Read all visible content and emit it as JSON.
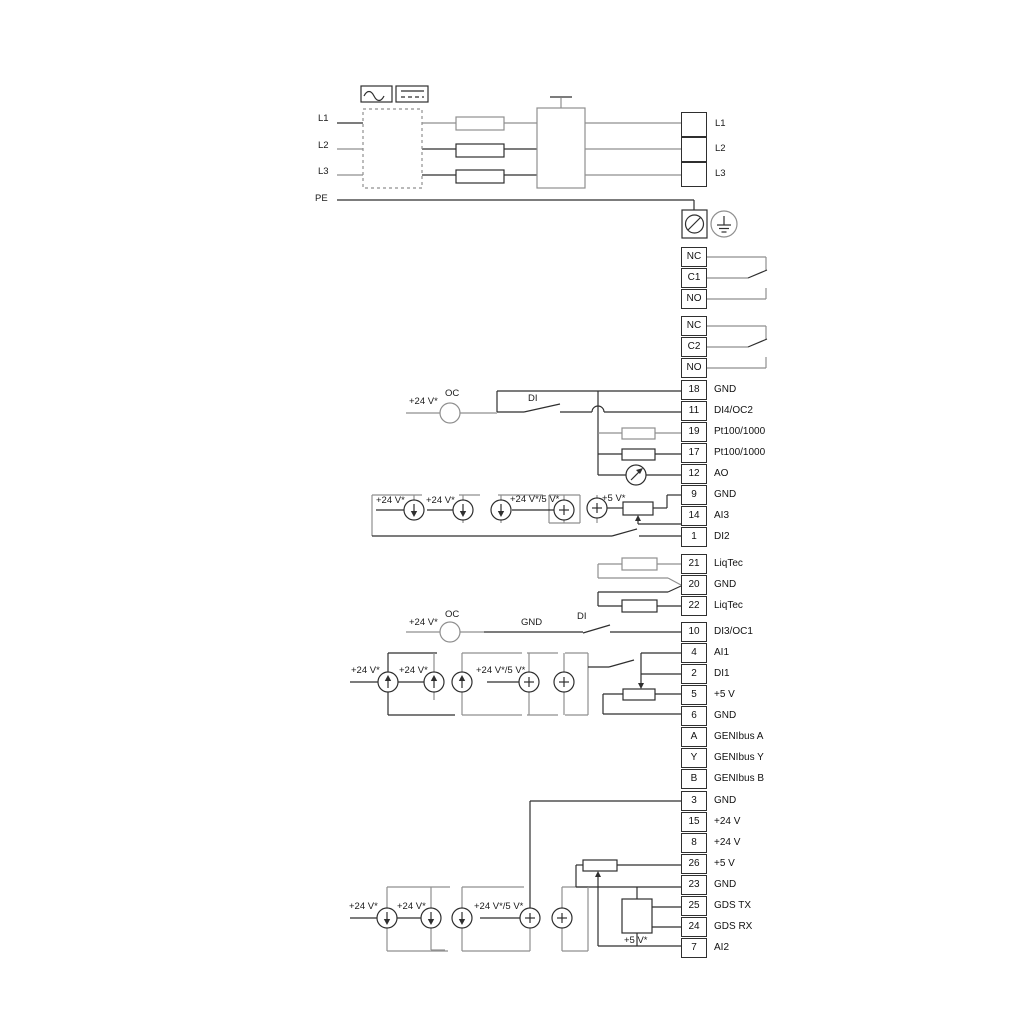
{
  "title": "Drive wiring diagram",
  "colors": {
    "wire_gray": "#8f8f8f",
    "wire_dark": "#2f2f2f",
    "text": "#1a1a1a",
    "background": "#ffffff"
  },
  "icons": [
    "ac-waveform-icon",
    "dc-symbol-icon",
    "fuse-icon",
    "contactor-icon",
    "ground-screw-icon",
    "earth-icon",
    "current-source-icon",
    "open-collector-icon",
    "ao-meter-icon",
    "potentiometer-icon",
    "gds-sensor-icon",
    "switch-icon",
    "resistor-icon"
  ],
  "terminal_blocks": [
    {
      "name": "mains-output-block",
      "x": 681,
      "y": 112,
      "w": 26,
      "h": 25,
      "pitch": 25,
      "rows": [
        {
          "n": "",
          "l": ""
        },
        {
          "n": "",
          "l": ""
        },
        {
          "n": "",
          "l": ""
        }
      ]
    },
    {
      "name": "relay-1-block",
      "x": 681,
      "y": 247,
      "w": 26,
      "h": 20,
      "pitch": 21,
      "rows": [
        {
          "n": "NC",
          "l": ""
        },
        {
          "n": "C1",
          "l": ""
        },
        {
          "n": "NO",
          "l": ""
        }
      ]
    },
    {
      "name": "relay-2-block",
      "x": 681,
      "y": 316,
      "w": 26,
      "h": 20,
      "pitch": 21,
      "rows": [
        {
          "n": "NC",
          "l": ""
        },
        {
          "n": "C2",
          "l": ""
        },
        {
          "n": "NO",
          "l": ""
        }
      ]
    },
    {
      "name": "io-block-1",
      "x": 681,
      "y": 380,
      "w": 26,
      "h": 20,
      "pitch": 21,
      "rows": [
        {
          "n": "18",
          "l": "GND"
        },
        {
          "n": "11",
          "l": "DI4/OC2"
        },
        {
          "n": "19",
          "l": "Pt100/1000"
        },
        {
          "n": "17",
          "l": "Pt100/1000"
        },
        {
          "n": "12",
          "l": "AO"
        },
        {
          "n": "9",
          "l": "GND"
        },
        {
          "n": "14",
          "l": "AI3"
        },
        {
          "n": "1",
          "l": "DI2"
        }
      ]
    },
    {
      "name": "liqtec-block",
      "x": 681,
      "y": 554,
      "w": 26,
      "h": 20,
      "pitch": 21,
      "rows": [
        {
          "n": "21",
          "l": "LiqTec"
        },
        {
          "n": "20",
          "l": "GND"
        },
        {
          "n": "22",
          "l": "LiqTec"
        }
      ]
    },
    {
      "name": "di3-block",
      "x": 681,
      "y": 622,
      "w": 26,
      "h": 20,
      "pitch": 21,
      "rows": [
        {
          "n": "10",
          "l": "DI3/OC1"
        }
      ]
    },
    {
      "name": "io-block-2",
      "x": 681,
      "y": 643,
      "w": 26,
      "h": 20,
      "pitch": 21,
      "rows": [
        {
          "n": "4",
          "l": "AI1"
        },
        {
          "n": "2",
          "l": "DI1"
        },
        {
          "n": "5",
          "l": "+5 V"
        },
        {
          "n": "6",
          "l": "GND"
        },
        {
          "n": "A",
          "l": "GENIbus A"
        },
        {
          "n": "Y",
          "l": "GENIbus Y"
        },
        {
          "n": "B",
          "l": "GENIbus B"
        }
      ]
    },
    {
      "name": "io-block-3",
      "x": 681,
      "y": 791,
      "w": 26,
      "h": 20,
      "pitch": 21,
      "rows": [
        {
          "n": "3",
          "l": "GND"
        },
        {
          "n": "15",
          "l": "+24 V"
        },
        {
          "n": "8",
          "l": "+24 V"
        },
        {
          "n": "26",
          "l": "+5 V"
        },
        {
          "n": "23",
          "l": "GND"
        },
        {
          "n": "25",
          "l": "GDS TX"
        },
        {
          "n": "24",
          "l": "GDS RX"
        },
        {
          "n": "7",
          "l": "AI2"
        }
      ]
    }
  ],
  "labels": [
    {
      "t": "L1",
      "x": 318,
      "y": 114
    },
    {
      "t": "L2",
      "x": 318,
      "y": 141
    },
    {
      "t": "L3",
      "x": 318,
      "y": 167
    },
    {
      "t": "PE",
      "x": 315,
      "y": 194
    },
    {
      "t": "L1",
      "x": 715,
      "y": 119
    },
    {
      "t": "L2",
      "x": 715,
      "y": 144
    },
    {
      "t": "L3",
      "x": 715,
      "y": 169
    },
    {
      "t": "+24 V*",
      "x": 409,
      "y": 397
    },
    {
      "t": "OC",
      "x": 445,
      "y": 389
    },
    {
      "t": "DI",
      "x": 528,
      "y": 394
    },
    {
      "t": "+24 V*",
      "x": 376,
      "y": 496
    },
    {
      "t": "+24 V*",
      "x": 426,
      "y": 496
    },
    {
      "t": "+24 V*/5 V*",
      "x": 510,
      "y": 495
    },
    {
      "t": "+5 V*",
      "x": 602,
      "y": 494
    },
    {
      "t": "+24 V*",
      "x": 409,
      "y": 618
    },
    {
      "t": "OC",
      "x": 445,
      "y": 610
    },
    {
      "t": "GND",
      "x": 521,
      "y": 618
    },
    {
      "t": "DI",
      "x": 577,
      "y": 612
    },
    {
      "t": "+24 V*",
      "x": 351,
      "y": 666
    },
    {
      "t": "+24 V*",
      "x": 399,
      "y": 666
    },
    {
      "t": "+24 V*/5 V*",
      "x": 476,
      "y": 666
    },
    {
      "t": "+24 V*",
      "x": 349,
      "y": 902
    },
    {
      "t": "+24 V*",
      "x": 397,
      "y": 902
    },
    {
      "t": "+24 V*/5 V*",
      "x": 474,
      "y": 902
    },
    {
      "t": "+5 V*",
      "x": 624,
      "y": 936
    }
  ]
}
